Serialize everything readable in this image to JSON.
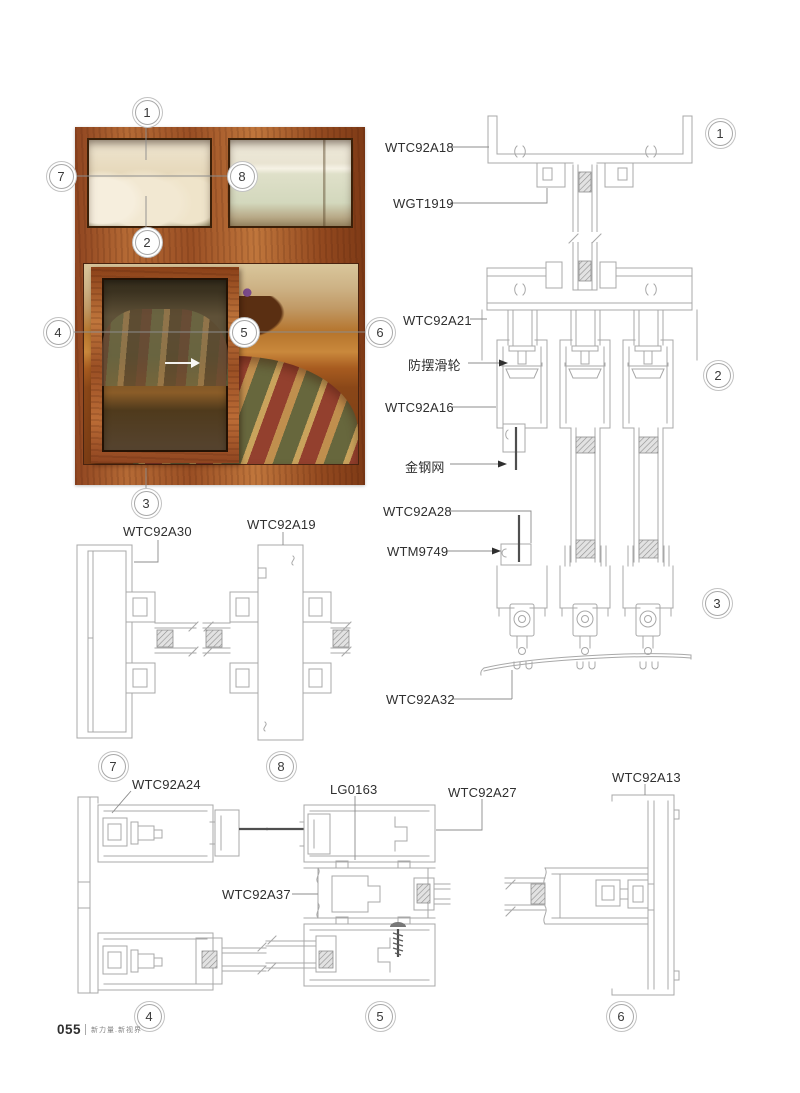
{
  "page": {
    "number": "055",
    "slogan": "新力量.新视界"
  },
  "callouts": {
    "n1": "1",
    "n2": "2",
    "n3": "3",
    "n4": "4",
    "n5": "5",
    "n6": "6",
    "n7": "7",
    "n8": "8"
  },
  "labels": {
    "wtc92a18": "WTC92A18",
    "wgt1919": "WGT1919",
    "wtc92a21": "WTC92A21",
    "anti_sway_roller": "防摆滑轮",
    "wtc92a16": "WTC92A16",
    "steel_mesh": "金钢网",
    "wtc92a28": "WTC92A28",
    "wtm9749": "WTM9749",
    "wtc92a32": "WTC92A32",
    "wtc92a30": "WTC92A30",
    "wtc92a19": "WTC92A19",
    "wtc92a24": "WTC92A24",
    "lg0163": "LG0163",
    "wtc92a27": "WTC92A27",
    "wtc92a13": "WTC92A13",
    "wtc92a37": "WTC92A37"
  },
  "colors": {
    "wood_frame": "#a5542b",
    "drawing_line": "#a8a8a8",
    "mesh_line": "#4f4f4f",
    "label_text": "#2f2f2f",
    "callout_ring": "#c2c2c2"
  }
}
